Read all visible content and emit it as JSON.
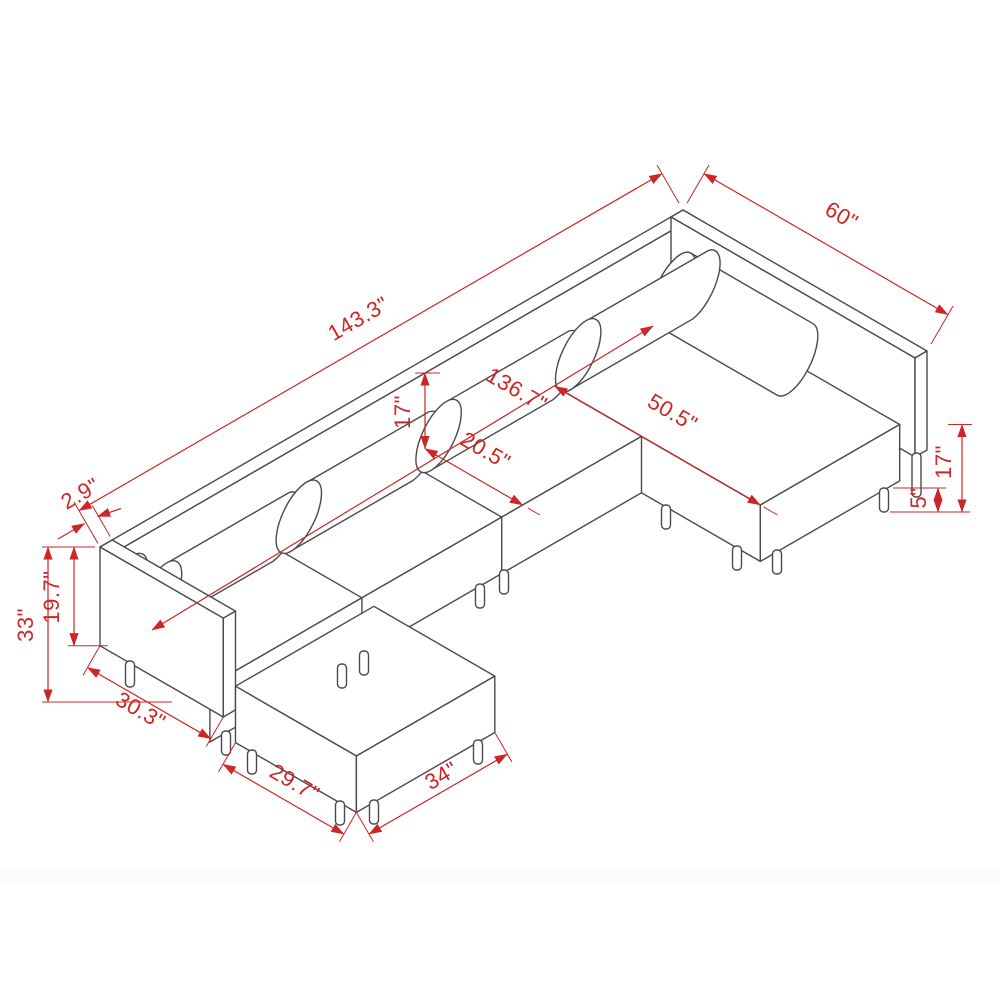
{
  "diagram": {
    "subject": "Isometric dimension drawing of a U-shaped modular sectional sofa with bolster pillows and two ottomans",
    "type": "technical line drawing",
    "colors": {
      "outline": "#4a4a4a",
      "dimension": "#cc2626",
      "background": "#ffffff"
    },
    "dimensions": [
      {
        "id": "back-overall-width",
        "label": "143.3\"",
        "orientation": "isometric-left"
      },
      {
        "id": "right-wing-length",
        "label": "60\"",
        "orientation": "isometric-right"
      },
      {
        "id": "chaise-total-length",
        "label": "50.5\"",
        "orientation": "isometric-right"
      },
      {
        "id": "backrest-above-seat",
        "label": "17\"",
        "orientation": "vertical"
      },
      {
        "id": "seat-depth",
        "label": "20.5\"",
        "orientation": "isometric-right"
      },
      {
        "id": "interior-width",
        "label": "136.7\"",
        "orientation": "isometric-right"
      },
      {
        "id": "arm-thickness",
        "label": "2.9\"",
        "orientation": "isometric-left"
      },
      {
        "id": "overall-height",
        "label": "33\"",
        "orientation": "vertical"
      },
      {
        "id": "arm-panel-height",
        "label": "19.7\"",
        "orientation": "vertical"
      },
      {
        "id": "left-arm-depth",
        "label": "30.3\"",
        "orientation": "isometric-right"
      },
      {
        "id": "ottoman-depth",
        "label": "29.7\"",
        "orientation": "isometric-right"
      },
      {
        "id": "ottoman-width",
        "label": "34\"",
        "orientation": "isometric-left"
      },
      {
        "id": "seat-height",
        "label": "17\"",
        "orientation": "vertical"
      },
      {
        "id": "leg-height",
        "label": "5\"",
        "orientation": "vertical"
      }
    ],
    "parts": [
      "back rail",
      "right wing rail",
      "right chaise",
      "seat cushions",
      "bolster pillows",
      "left arm panel",
      "left ottoman",
      "cylindrical legs"
    ]
  }
}
